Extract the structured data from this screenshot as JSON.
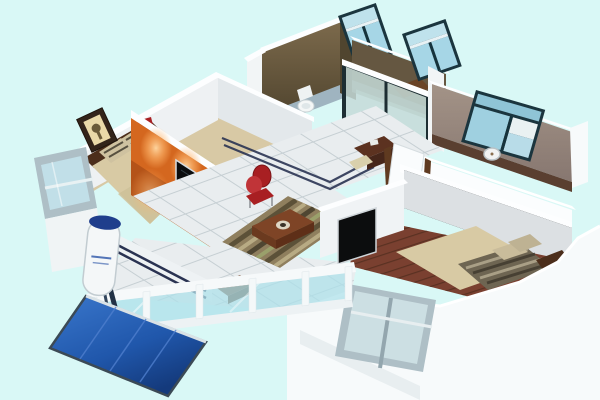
{
  "scene": {
    "type": "3d-isometric-floorplan-render",
    "description": "Cutaway 3D render of a two-bedroom apartment viewed from above"
  },
  "palette": {
    "background": "#d9f8f6",
    "wall_white": "#f7fafb",
    "wall_shadow": "#e4eaee",
    "wall_top": "#fdfeff",
    "bathroom_wall": "#6e5c41",
    "bathroom_wall_dark": "#50452f",
    "kitchen_wall": "#5e5038",
    "bedroom3_wall": "#97877e",
    "orange_wall": "#d4671f",
    "orange_glow": "#ffbe7d",
    "carpet": "#d8c9a5",
    "wood_floor": "#7a4030",
    "tile": "#e9edef",
    "tile_line": "#c6cfd3",
    "navy_inlay": "#2a3352",
    "glass": "#a6d6e6",
    "glass_light": "#cfe8f0",
    "window_frame": "#1b353e",
    "window_frame_gray": "#aebfc6",
    "rail_glass": "#aee0ea",
    "red_accent": "#a81f22",
    "tv_screen": "#0c0d0e",
    "bed": "#d8caa4",
    "headboard": "#4c2e1b",
    "dark_wood": "#5c3220",
    "table_wood": "#7e4426",
    "solar_panel": "#2057ab",
    "tank": "#f4f7f8",
    "tank_cap": "#1f3e8c"
  },
  "rooms": [
    {
      "name": "master-bedroom",
      "position": "top-left",
      "furniture": [
        "double-bed",
        "striped-pillows",
        "framed-picture",
        "nightstand",
        "red-table-lamp",
        "tilted-window"
      ]
    },
    {
      "name": "living-room",
      "position": "center",
      "furniture": [
        "orange-accent-wall",
        "wall-tv",
        "spotlights",
        "striped-rug",
        "coffee-table",
        "red-chair",
        "wood-bench"
      ]
    },
    {
      "name": "bathroom",
      "position": "top-center",
      "furniture": [
        "toilet",
        "window"
      ]
    },
    {
      "name": "kitchen",
      "position": "top-center-right",
      "furniture": [
        "glass-sliding-doors",
        "counter-table",
        "window"
      ]
    },
    {
      "name": "study-room",
      "position": "right",
      "furniture": [
        "window",
        "wall-clock"
      ]
    },
    {
      "name": "second-bedroom",
      "position": "bottom-right",
      "furniture": [
        "double-bed",
        "striped-blanket",
        "wall-tv",
        "leaning-window"
      ]
    },
    {
      "name": "balcony",
      "position": "bottom-left",
      "furniture": [
        "glass-railing",
        "solar-water-heater",
        "solar-panel"
      ]
    },
    {
      "name": "hallway",
      "position": "center-right",
      "furniture": [
        "desk",
        "chair",
        "open-white-door",
        "navy-floor-inlay"
      ]
    }
  ]
}
